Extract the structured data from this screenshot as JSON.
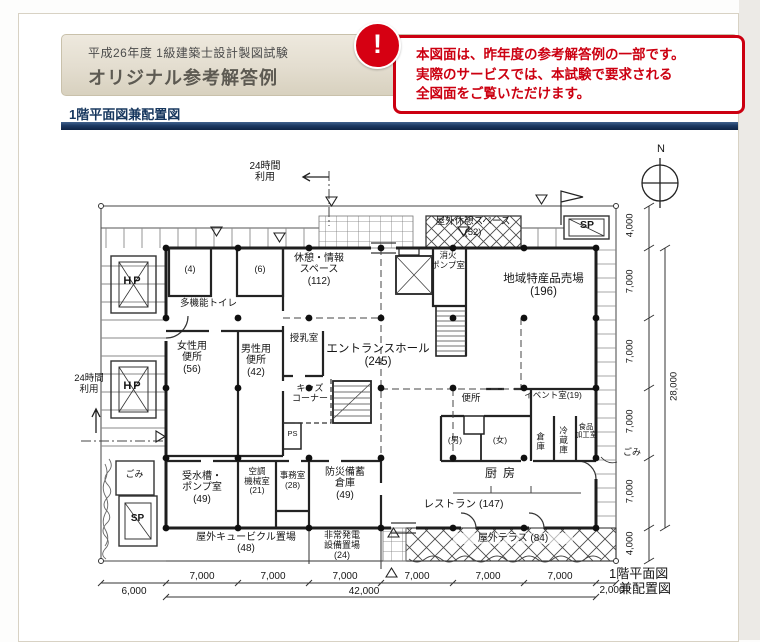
{
  "header": {
    "exam": "平成26年度 1級建築士設計製図試験",
    "title": "オリジナル参考解答例"
  },
  "section": {
    "label": "1階平面図兼配置図"
  },
  "notice": {
    "icon": "!",
    "line1": "本図面は、昨年度の参考解答例の一部です。",
    "line2": "実際のサービスでは、本試験で要求される",
    "line3": "全図面をご覧いただけます。"
  },
  "plan": {
    "drawing_title_line1": "1階平面図",
    "drawing_title_line2": "兼配置図",
    "compass_label": "N",
    "notes": {
      "use24_top_line1": "24時間",
      "use24_top_line2": "利用",
      "use24_left_line1": "24時間",
      "use24_left_line2": "利用",
      "trash_note": "ごみ"
    },
    "site_marks": {
      "hp": "HP",
      "sp": "SP",
      "trash": "ごみ"
    },
    "rooms": {
      "outdoor_rest": {
        "name": "屋外休憩スペース",
        "area": "(52)"
      },
      "fire_pump": {
        "name": "消火",
        "name2": "ポンプ室"
      },
      "local_products": {
        "name": "地域特産品売場",
        "area": "(196)"
      },
      "multi_toilet": {
        "name": "多機能トイレ",
        "left_area": "(4)",
        "right_area": "(6)"
      },
      "rest_info": {
        "name": "休憩・情報",
        "name2": "スペース",
        "area": "(112)"
      },
      "womens_toilet": {
        "name": "女性用",
        "name2": "便所",
        "area": "(56)"
      },
      "mens_toilet": {
        "name": "男性用",
        "name2": "便所",
        "area": "(42)"
      },
      "nursing": {
        "name": "授乳室"
      },
      "kids": {
        "name": "キッズ",
        "name2": "コーナー"
      },
      "ps": {
        "name": "PS"
      },
      "entrance_hall": {
        "name": "エントランスホール",
        "area": "(245)"
      },
      "toilet": {
        "name": "便所",
        "male": "(男)",
        "female": "(女)"
      },
      "event": {
        "name": "イベント室(19)"
      },
      "storage": {
        "name": "倉庫"
      },
      "refrigerator": {
        "name": "冷蔵庫"
      },
      "food_processing": {
        "name": "食品",
        "name2": "加工室"
      },
      "kitchen": {
        "name": "厨房"
      },
      "restaurant": {
        "name": "レストラン (147)"
      },
      "water_tank": {
        "name": "受水槽・",
        "name2": "ポンプ室",
        "area": "(49)"
      },
      "hvac": {
        "name": "空調",
        "name2": "機械室",
        "area": "(21)"
      },
      "office": {
        "name": "事務室",
        "area": "(28)"
      },
      "disaster_storage": {
        "name": "防災備蓄",
        "name2": "倉庫",
        "area": "(49)"
      },
      "cubicle_yard": {
        "name": "屋外キュービクル置場",
        "area": "(48)"
      },
      "generator_yard": {
        "name": "非常発電",
        "name2": "設備置場",
        "area": "(24)"
      },
      "terrace": {
        "name": "屋外テラス (84)"
      }
    },
    "dimensions": {
      "bottom": [
        "6,000",
        "7,000",
        "7,000",
        "7,000",
        "7,000",
        "7,000",
        "7,000",
        "2,000"
      ],
      "bottom_total": "42,000",
      "right": [
        "4,000",
        "7,000",
        "7,000",
        "7,000",
        "7,000",
        "4,000"
      ],
      "right_total": "28,000"
    }
  }
}
